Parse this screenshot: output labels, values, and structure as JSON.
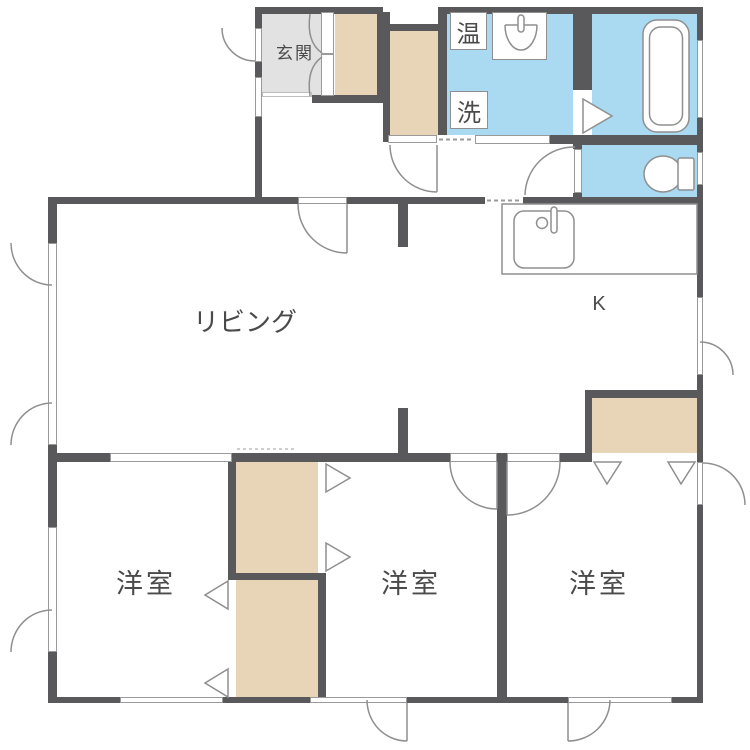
{
  "rooms": {
    "genkan": {
      "label": "玄関"
    },
    "living": {
      "label": "リビング"
    },
    "kitchen": {
      "label": "K"
    },
    "bedroom_left": {
      "label": "洋室"
    },
    "bedroom_middle": {
      "label": "洋室"
    },
    "bedroom_right": {
      "label": "洋室"
    }
  },
  "fixtures": {
    "water_heater": {
      "label": "温"
    },
    "washing_machine": {
      "label": "洗"
    }
  },
  "icons": {
    "bathtub-icon": "double rounded rectangle",
    "toilet-icon": "ellipse bowl + tank rectangle",
    "kitchen-sink-icon": "rounded square sink + faucet circle and stem",
    "washbasin-icon": "half-ellipse bowl + faucet pill",
    "door-swing-arc-icon": "quarter circle arc",
    "folding-door-icon": "triangle",
    "sliding-opening-icon": "white bar with dashed track",
    "window-icon": "white gap in wall with thin outline"
  },
  "colors": {
    "wall": "#59595b",
    "closet": "#e8d5b8",
    "wet": "#aadaf2",
    "genkan": "#e2e2e2",
    "line": "#8f8f8f"
  }
}
